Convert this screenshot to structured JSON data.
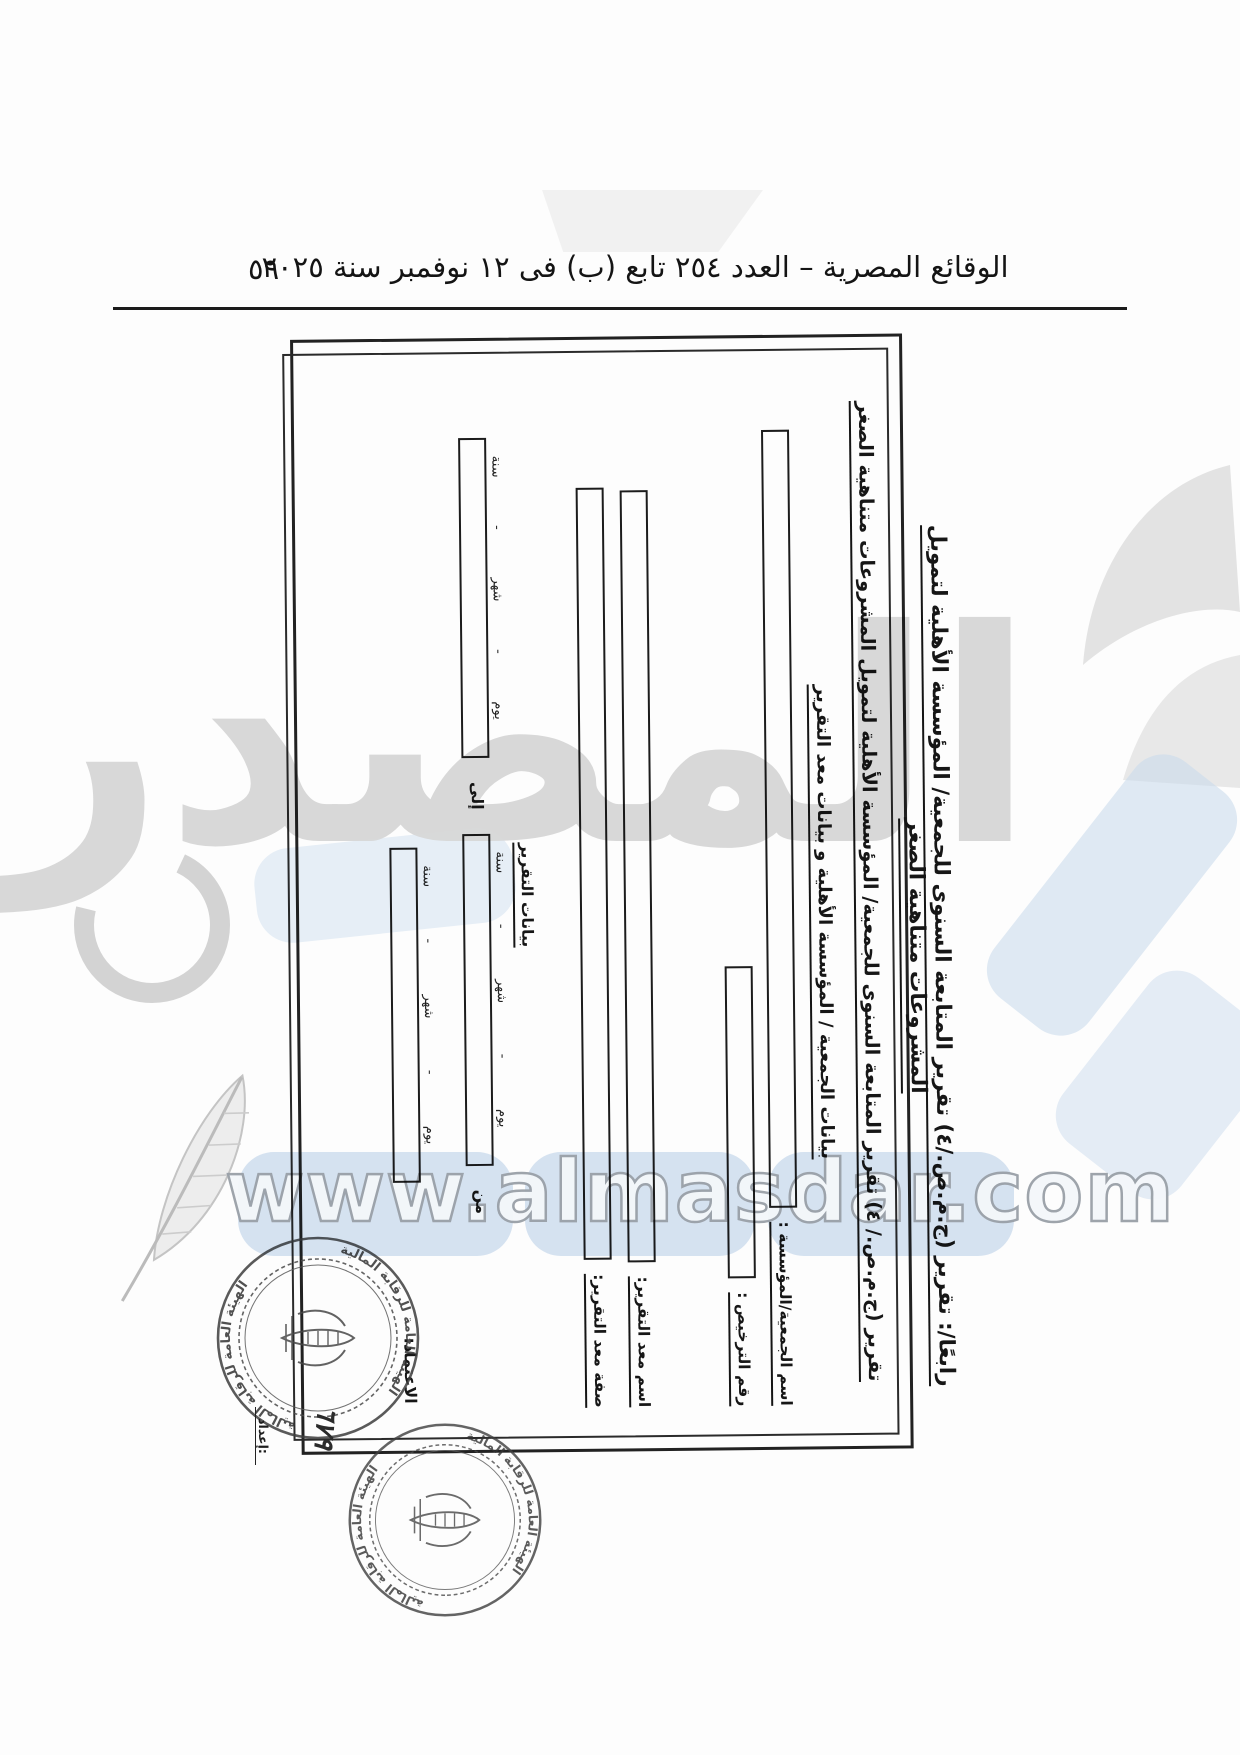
{
  "header": {
    "gazette_title": "الوقائع المصرية – العدد ٢٥٤ تابع (ب) فى ١٢ نوفمبر سنة ٢٠٢٥",
    "page_number": "٥٩"
  },
  "form": {
    "main_title": "رابعًا/: تقرير (ج.م.ص./٤) تقرير المتابعة السنوى للجمعية/ المؤسسة الأهلية لتمويل المشروعات متناهية الصغر",
    "inner_heading": "تقرير (ج.م.ص./ ٤) تقرير المتابعة السنوى للجمعية/ المؤسسة الأهلية لتمويل المشروعات متناهية الصغر",
    "section1_heading": "بيانات الجمعية / المؤسسة الأهلية و بيانات معد التقرير",
    "fields": [
      {
        "label": "اسم الجمعية/المؤسسة :"
      },
      {
        "label": "رقم الترخيص :"
      },
      {
        "label": "اسم معد التقرير:"
      },
      {
        "label": "صفة معد التقرير:"
      }
    ],
    "section2_heading": "بيانات التقرير",
    "from_label": "من",
    "to_label": "إلى",
    "date_parts": {
      "day": "يوم",
      "month": "شهر",
      "year": "سنة",
      "sep": "-"
    },
    "approval_label": "الاعتماد:",
    "prepared_label": "إعداد:",
    "handwritten_number": "٦٧٩"
  },
  "stamps": {
    "authority_name": "الهيئة العامة للرقابة المالية"
  },
  "watermark": {
    "logo_text": "المصدر",
    "url_text": "www.almasdar.com"
  }
}
